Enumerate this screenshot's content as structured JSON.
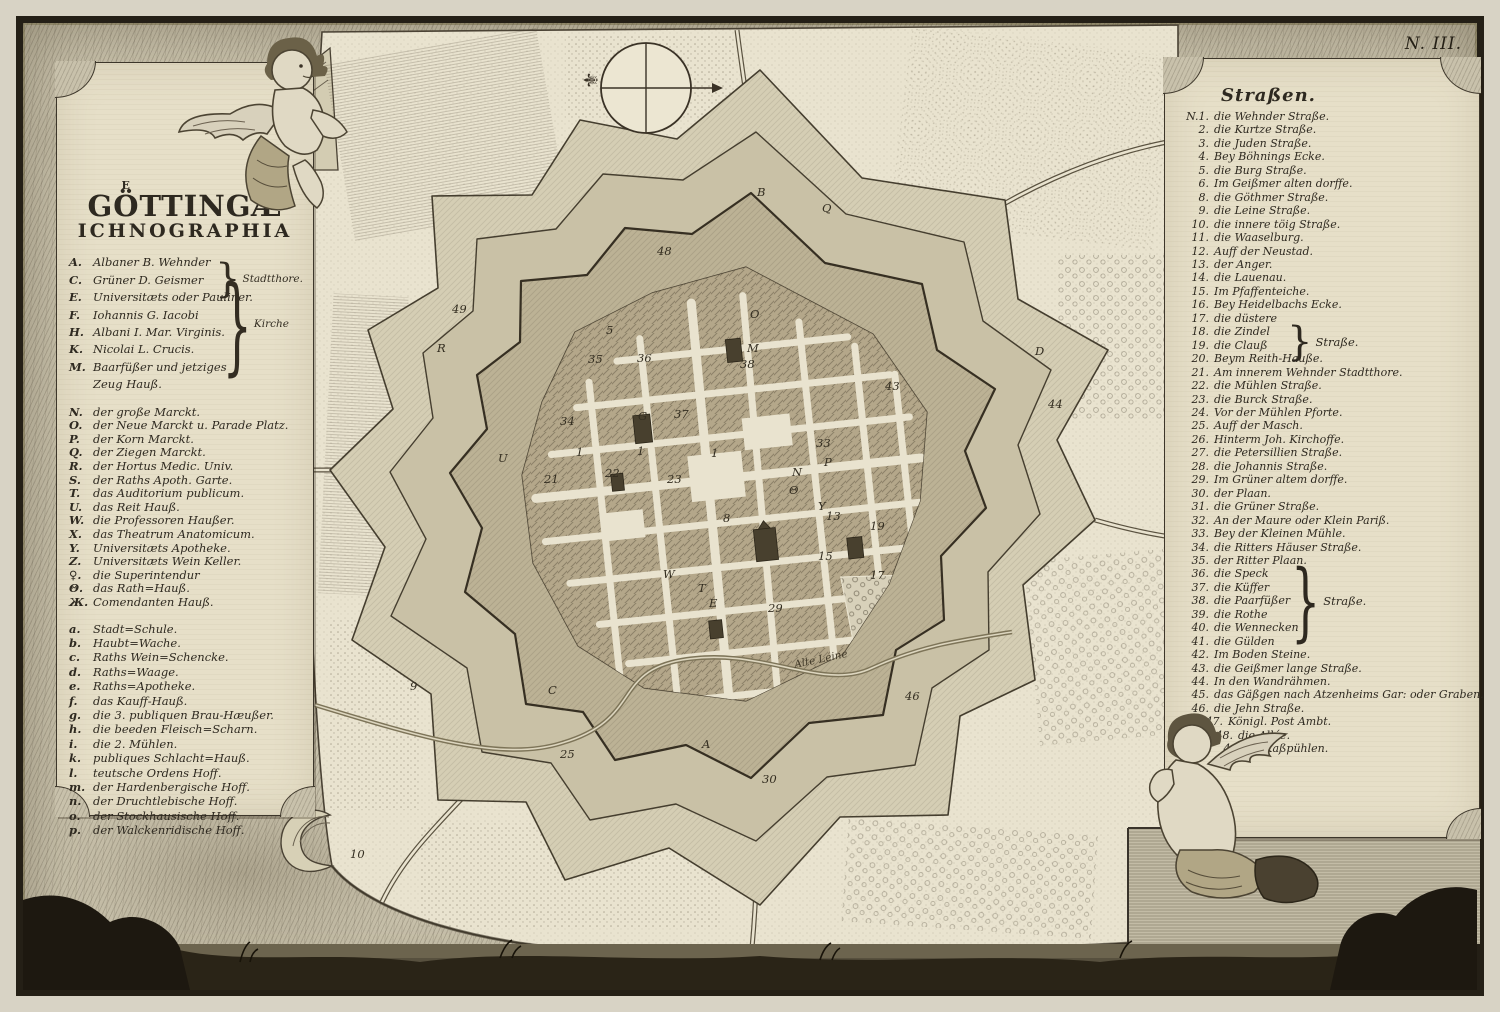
{
  "plate_no": "N. III.",
  "title": {
    "sup": "E",
    "main": "GÖTTINGÆ",
    "sub": "ICHNOGRAPHIA"
  },
  "legend": {
    "gates_churches": [
      {
        "k": "A.",
        "t": "Albaner   B. Wehnder"
      },
      {
        "k": "C.",
        "t": "Grüner   D. Geismer"
      },
      {
        "k": "E.",
        "t": "Universitæts oder Pauliner."
      },
      {
        "k": "F.",
        "t": "Iohannis   G. Iacobi"
      },
      {
        "k": "H.",
        "t": "Albani   I. Mar. Virginis."
      },
      {
        "k": "K.",
        "t": "Nicolai   L. Crucis."
      },
      {
        "k": "M.",
        "t": "Baarfüßer und jetziges"
      },
      {
        "k": "",
        "t": "Zeug Hauß."
      }
    ],
    "brace_gates_label": "Stadtthore.",
    "brace_kirche_label": "Kirche",
    "places": [
      {
        "k": "N.",
        "t": "der große Marckt."
      },
      {
        "k": "O.",
        "t": "der Neue Marckt u. Parade Platz."
      },
      {
        "k": "P.",
        "t": "der Korn Marckt."
      },
      {
        "k": "Q.",
        "t": "der Ziegen Marckt."
      },
      {
        "k": "R.",
        "t": "der Hortus Medic. Univ."
      },
      {
        "k": "S.",
        "t": "der Raths Apoth. Garte."
      },
      {
        "k": "T.",
        "t": "das Auditorium publicum."
      },
      {
        "k": "U.",
        "t": "das Reit Hauß."
      },
      {
        "k": "W.",
        "t": "die Professoren Haußer."
      },
      {
        "k": "X.",
        "t": "das Theatrum Anatomicum."
      },
      {
        "k": "Y.",
        "t": "Universitæts Apotheke."
      },
      {
        "k": "Z.",
        "t": "Universitæts Wein Keller."
      },
      {
        "k": "♀.",
        "t": "die Superintendur"
      },
      {
        "k": "Θ.",
        "t": "das Rath=Hauß."
      },
      {
        "k": "Ж.",
        "t": "Comendanten Hauß."
      }
    ],
    "buildings": [
      {
        "k": "a.",
        "t": "Stadt=Schule."
      },
      {
        "k": "b.",
        "t": "Haubt=Wache."
      },
      {
        "k": "c.",
        "t": "Raths Wein=Schencke."
      },
      {
        "k": "d.",
        "t": "Raths=Waage."
      },
      {
        "k": "e.",
        "t": "Raths=Apotheke."
      },
      {
        "k": "f.",
        "t": "das Kauff-Hauß."
      },
      {
        "k": "g.",
        "t": "die 3. publiquen Brau-Hæußer."
      },
      {
        "k": "h.",
        "t": "die beeden Fleisch=Scharn."
      },
      {
        "k": "i.",
        "t": "die 2. Mühlen."
      },
      {
        "k": "k.",
        "t": "publiques Schlacht=Hauß."
      },
      {
        "k": "l.",
        "t": "teutsche Ordens Hoff."
      },
      {
        "k": "m.",
        "t": "der Hardenbergische Hoff."
      },
      {
        "k": "n.",
        "t": "der Druchtlebische Hoff."
      },
      {
        "k": "o.",
        "t": "der Stockhausische Hoff."
      },
      {
        "k": "p.",
        "t": "der Walckenridische Hoff."
      }
    ]
  },
  "streets": {
    "header": "Straßen.",
    "brace1_label": "Straße.",
    "brace2_label": "Straße.",
    "items": [
      {
        "n": "N.1.",
        "t": "die Wehnder Straße."
      },
      {
        "n": "2.",
        "t": "die Kurtze Straße."
      },
      {
        "n": "3.",
        "t": "die Juden Straße."
      },
      {
        "n": "4.",
        "t": "Bey Böhnings Ecke."
      },
      {
        "n": "5.",
        "t": "die Burg Straße."
      },
      {
        "n": "6.",
        "t": "Im Geißmer alten dorffe."
      },
      {
        "n": "8.",
        "t": "die Göthmer Straße."
      },
      {
        "n": "9.",
        "t": "die Leine Straße."
      },
      {
        "n": "10.",
        "t": "die innere töig Straße."
      },
      {
        "n": "11.",
        "t": "die Waaselburg."
      },
      {
        "n": "12.",
        "t": "Auff der Neustad."
      },
      {
        "n": "13.",
        "t": "der Anger."
      },
      {
        "n": "14.",
        "t": "die Lauenau."
      },
      {
        "n": "15.",
        "t": "Im Pfaffenteiche."
      },
      {
        "n": "16.",
        "t": "Bey Heidelbachs Ecke."
      },
      {
        "n": "17.",
        "t": "die düstere"
      },
      {
        "n": "18.",
        "t": "die Zindel"
      },
      {
        "n": "19.",
        "t": "die Clauß"
      },
      {
        "n": "20.",
        "t": "Beym Reith-Hauße."
      },
      {
        "n": "21.",
        "t": "Am innerem Wehnder Stadtthore."
      },
      {
        "n": "22.",
        "t": "die Mühlen Straße."
      },
      {
        "n": "23.",
        "t": "die Burck Straße."
      },
      {
        "n": "24.",
        "t": "Vor der Mühlen Pforte."
      },
      {
        "n": "25.",
        "t": "Auff der Masch."
      },
      {
        "n": "26.",
        "t": "Hinterm Joh. Kirchoffe."
      },
      {
        "n": "27.",
        "t": "die Petersillien Straße."
      },
      {
        "n": "28.",
        "t": "die Johannis Straße."
      },
      {
        "n": "29.",
        "t": "Im Grüner altem dorffe."
      },
      {
        "n": "30.",
        "t": "der Plaan."
      },
      {
        "n": "31.",
        "t": "die Grüner Straße."
      },
      {
        "n": "32.",
        "t": "An der Maure oder Klein Pariß."
      },
      {
        "n": "33.",
        "t": "Bey der Kleinen Mühle."
      },
      {
        "n": "34.",
        "t": "die Ritters Häuser Straße."
      },
      {
        "n": "35.",
        "t": "der Ritter Plaan."
      },
      {
        "n": "36.",
        "t": "die Speck"
      },
      {
        "n": "37.",
        "t": "die Küffer"
      },
      {
        "n": "38.",
        "t": "die Paarfüßer"
      },
      {
        "n": "39.",
        "t": "die Rothe"
      },
      {
        "n": "40.",
        "t": "die Wennecken"
      },
      {
        "n": "41.",
        "t": "die Gülden"
      },
      {
        "n": "42.",
        "t": "Im Boden Steine."
      },
      {
        "n": "43.",
        "t": "die Geißmer lange Straße."
      },
      {
        "n": "44.",
        "t": "In den Wandrähmen."
      },
      {
        "n": "45.",
        "t": "das Gäßgen nach Atzenheims Gar: oder Graben."
      },
      {
        "n": "46.",
        "t": "die Jehn Straße."
      },
      {
        "n": "47.",
        "t": "Königl. Post Ambt.",
        "ind": 14
      },
      {
        "n": "48.",
        "t": "die Allée.",
        "ind": 24
      },
      {
        "n": "49.",
        "t": "Im Kaßpühlen.",
        "ind": 32
      }
    ]
  },
  "map": {
    "stream_label": "Alte Leine",
    "labels": [
      {
        "t": "B",
        "x": 757,
        "y": 196
      },
      {
        "t": "Q",
        "x": 822,
        "y": 212
      },
      {
        "t": "D",
        "x": 1035,
        "y": 355
      },
      {
        "t": "A",
        "x": 702,
        "y": 748
      },
      {
        "t": "C",
        "x": 548,
        "y": 694
      },
      {
        "t": "R",
        "x": 437,
        "y": 352
      },
      {
        "t": "U",
        "x": 498,
        "y": 462
      },
      {
        "t": "O",
        "x": 750,
        "y": 318
      },
      {
        "t": "M",
        "x": 747,
        "y": 352
      },
      {
        "t": "G",
        "x": 638,
        "y": 420
      },
      {
        "t": "N",
        "x": 792,
        "y": 476
      },
      {
        "t": "P",
        "x": 824,
        "y": 466
      },
      {
        "t": "Θ",
        "x": 789,
        "y": 494
      },
      {
        "t": "Y",
        "x": 818,
        "y": 510
      },
      {
        "t": "W",
        "x": 663,
        "y": 578
      },
      {
        "t": "T",
        "x": 698,
        "y": 592
      },
      {
        "t": "E",
        "x": 709,
        "y": 607
      },
      {
        "t": "49",
        "x": 452,
        "y": 313
      },
      {
        "t": "48",
        "x": 657,
        "y": 255
      },
      {
        "t": "35",
        "x": 588,
        "y": 363
      },
      {
        "t": "36",
        "x": 637,
        "y": 362
      },
      {
        "t": "38",
        "x": 740,
        "y": 368
      },
      {
        "t": "37",
        "x": 674,
        "y": 418
      },
      {
        "t": "34",
        "x": 560,
        "y": 425
      },
      {
        "t": "33",
        "x": 816,
        "y": 447
      },
      {
        "t": "5",
        "x": 606,
        "y": 334
      },
      {
        "t": "43",
        "x": 885,
        "y": 390
      },
      {
        "t": "44",
        "x": 1048,
        "y": 408
      },
      {
        "t": "1",
        "x": 576,
        "y": 456
      },
      {
        "t": "1",
        "x": 637,
        "y": 455
      },
      {
        "t": "1",
        "x": 711,
        "y": 457
      },
      {
        "t": "21",
        "x": 544,
        "y": 483
      },
      {
        "t": "22",
        "x": 605,
        "y": 477
      },
      {
        "t": "23",
        "x": 667,
        "y": 483
      },
      {
        "t": "8",
        "x": 723,
        "y": 522
      },
      {
        "t": "13",
        "x": 826,
        "y": 520
      },
      {
        "t": "19",
        "x": 870,
        "y": 530
      },
      {
        "t": "15",
        "x": 818,
        "y": 560
      },
      {
        "t": "17",
        "x": 870,
        "y": 579
      },
      {
        "t": "29",
        "x": 768,
        "y": 612
      },
      {
        "t": "30",
        "x": 762,
        "y": 783
      },
      {
        "t": "25",
        "x": 560,
        "y": 758
      },
      {
        "t": "9",
        "x": 410,
        "y": 690
      },
      {
        "t": "46",
        "x": 905,
        "y": 700
      },
      {
        "t": "10",
        "x": 350,
        "y": 858
      }
    ]
  }
}
